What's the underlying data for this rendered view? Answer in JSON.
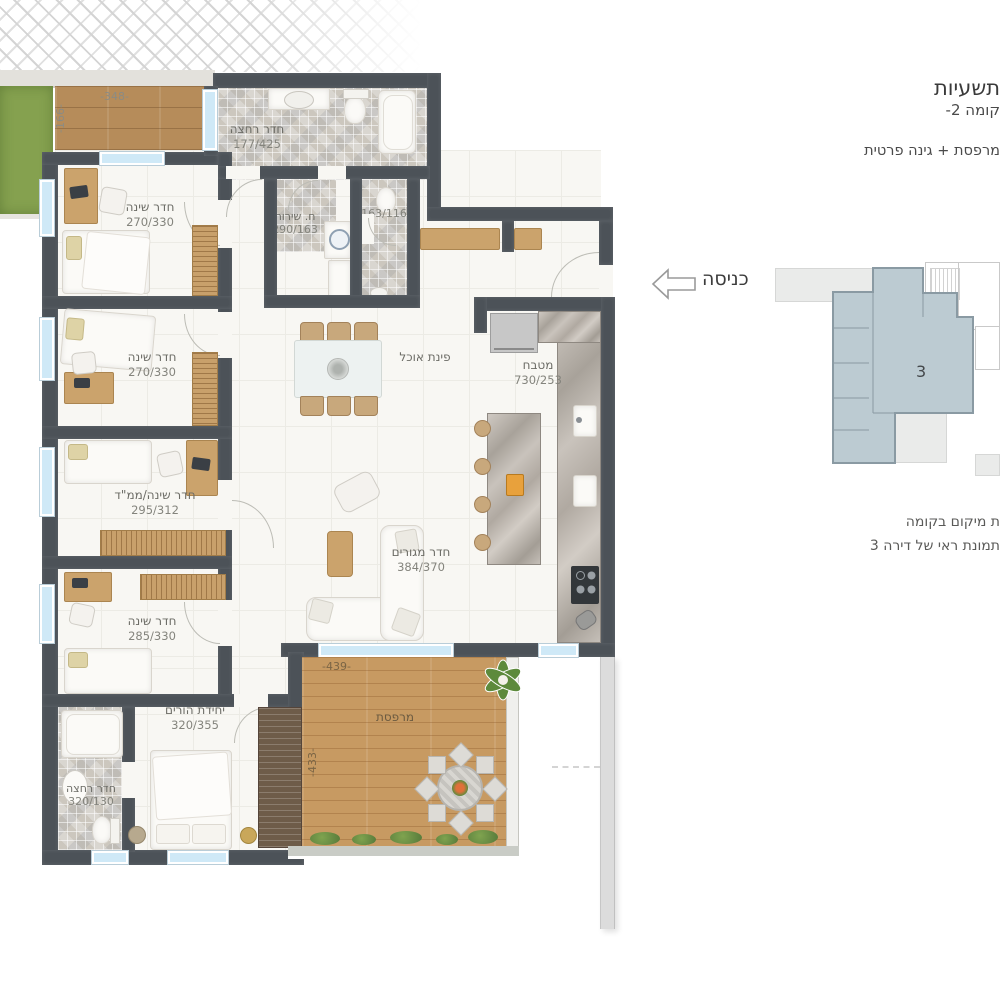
{
  "header": {
    "project_line": "תשעיות",
    "floor_line": "קומה 2-",
    "feature_line": "מרפסת + גינה פרטית"
  },
  "rooms": {
    "bath_top": {
      "name": "חדר רחצה",
      "dims": "177/425"
    },
    "utility": {
      "name": "ח. שירות",
      "dims": "290/163"
    },
    "wc": {
      "dims": "163/116"
    },
    "bedroom1": {
      "name": "חדר שינה",
      "dims": "270/330"
    },
    "bedroom2": {
      "name": "חדר שינה",
      "dims": "270/330"
    },
    "mamad": {
      "name": "חדר שינה/ממ\"ד",
      "dims": "295/312"
    },
    "bedroom4": {
      "name": "חדר שינה",
      "dims": "285/330"
    },
    "parents": {
      "name": "יחידת הורים",
      "dims": "320/355"
    },
    "bath_bottom": {
      "name": "חדר רחצה",
      "dims": "320/130"
    },
    "kitchen": {
      "name": "מטבח",
      "dims": "730/253"
    },
    "dining": {
      "name": "פינת אוכל"
    },
    "living": {
      "name": "חדר מגורים",
      "dims": "384/370"
    },
    "balcony": {
      "name": "מרפסת"
    }
  },
  "dimensions": {
    "deck_width": "-348-",
    "deck_height": "-166-",
    "balcony_width": "-439-",
    "balcony_height": "-433-"
  },
  "entrance": {
    "label": "כניסה"
  },
  "minimap": {
    "unit_number": "3"
  },
  "captions": {
    "line1": "ת מיקום בקומה",
    "line2": "תמונת ראי של דירה 3"
  },
  "colors": {
    "wall": "#4c5258",
    "deck_wood": "#b68c5a",
    "balcony_wood": "#c79a62",
    "garden": "#85a14f",
    "window": "#cfe9f7",
    "minimap_highlight": "#bccbd2",
    "label_text": "#6c6c66"
  }
}
